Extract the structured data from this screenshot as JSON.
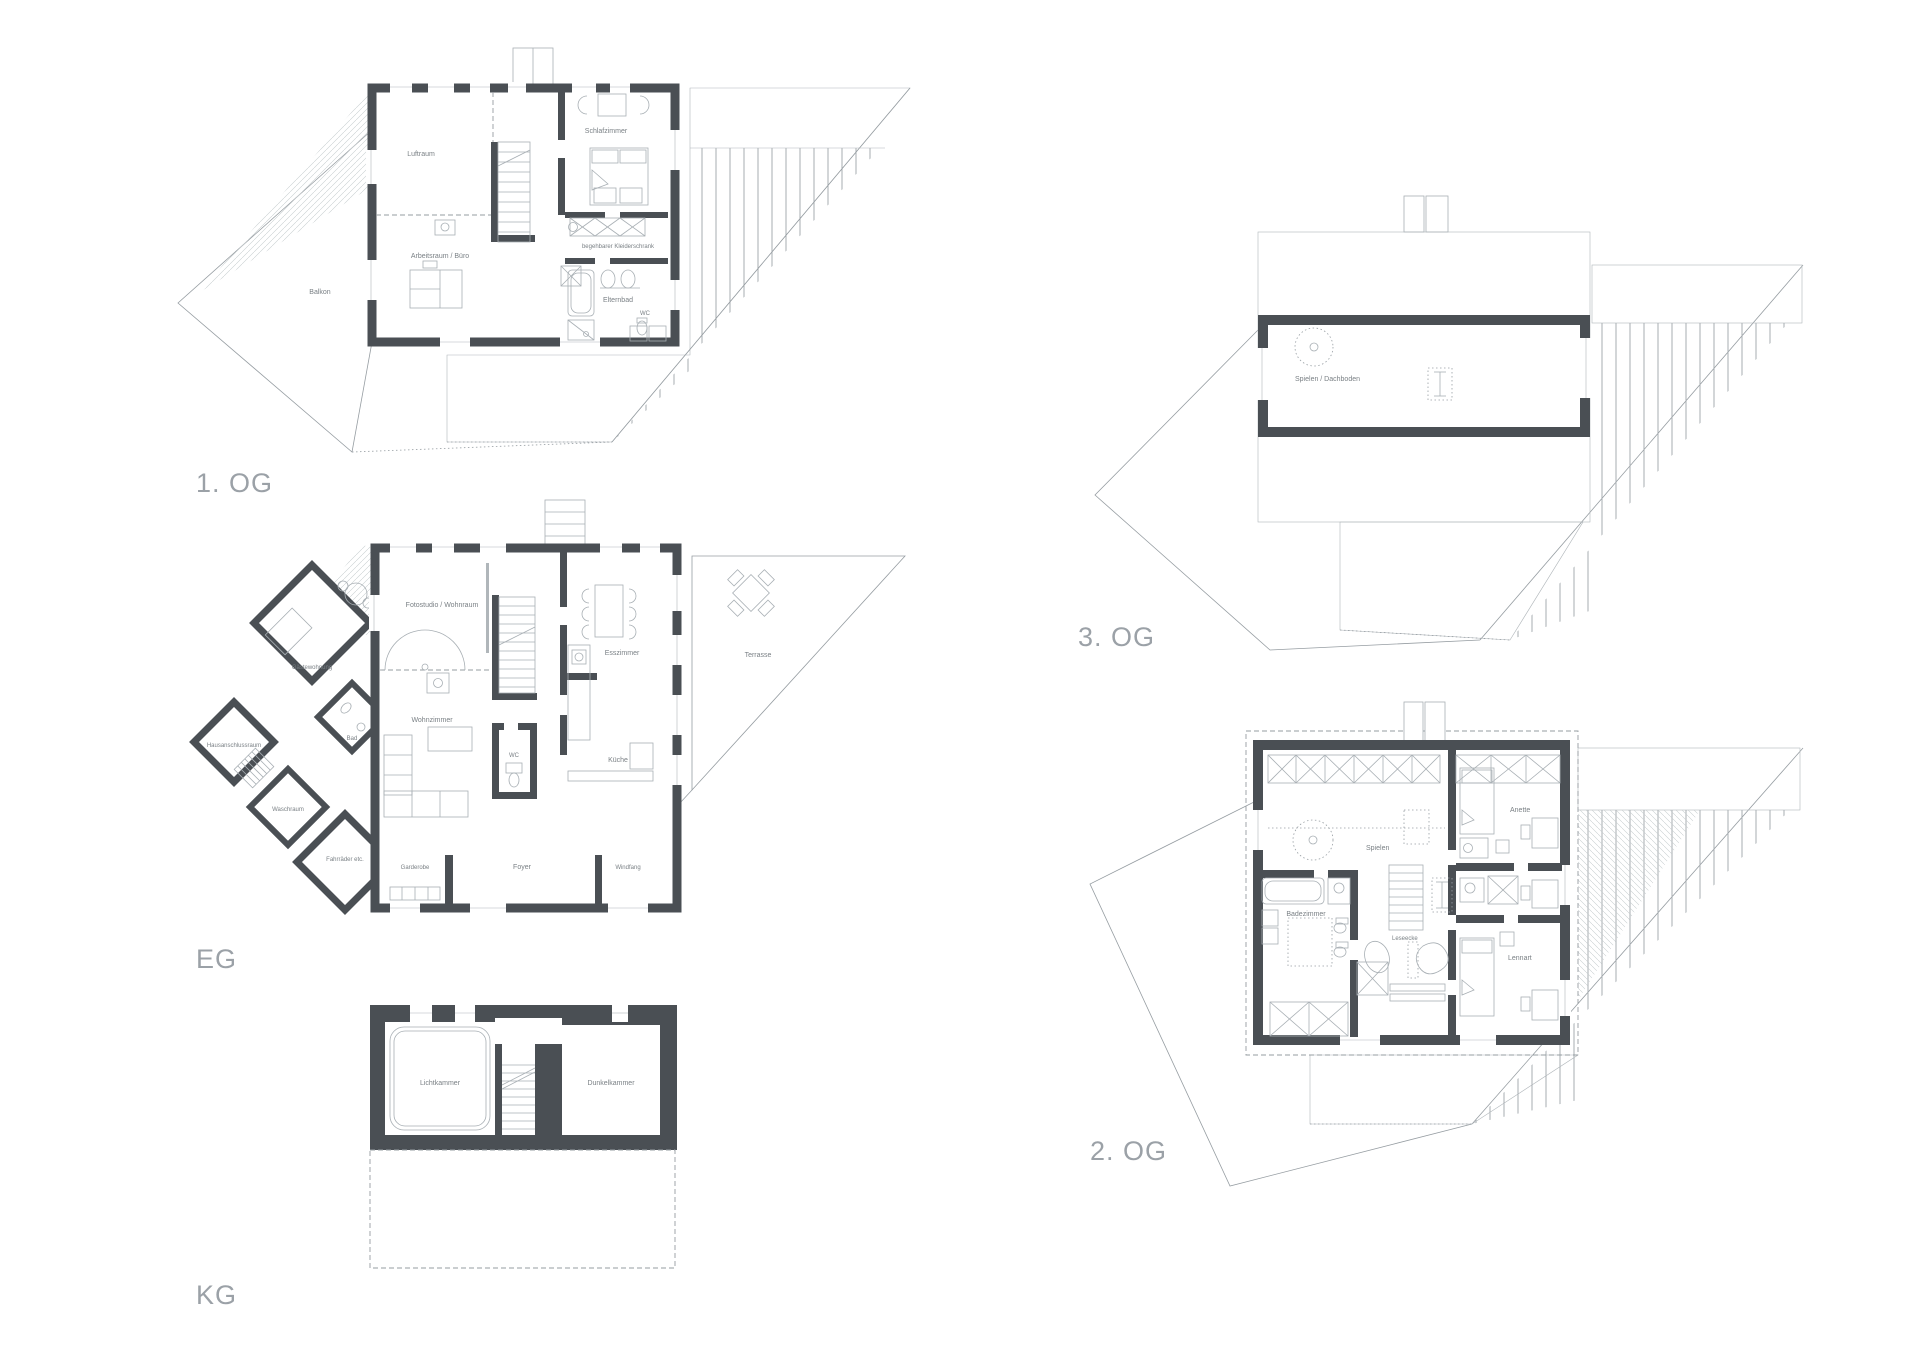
{
  "page": {
    "background": "#ffffff"
  },
  "colors": {
    "wall": "#4a4f54",
    "thin_line": "#969da2",
    "hatch": "#c3c8cb",
    "label_text": "#7a8085",
    "floor_label": "#9ba1a7"
  },
  "floors": {
    "og1": {
      "label": "1. OG",
      "rooms": {
        "luftraum": "Luftraum",
        "schlafzimmer": "Schlafzimmer",
        "arbeitsraum": "Arbeitsraum / Büro",
        "kleiderschrank": "begehbarer Kleiderschrank",
        "elternbad": "Elternbad",
        "wc": "WC",
        "balkon": "Balkon"
      }
    },
    "eg": {
      "label": "EG",
      "rooms": {
        "fotostudio": "Fotostudio / Wohnraum",
        "wohnzimmer": "Wohnzimmer",
        "esszimmer": "Esszimmer",
        "kueche": "Küche",
        "terrasse": "Terrasse",
        "wc": "WC",
        "foyer": "Foyer",
        "windfang": "Windfang",
        "garderobe": "Garderobe",
        "gaestewohnung": "Gästewohnung",
        "bad": "Bad",
        "hausanschlussraum": "Hausanschlussraum",
        "waschraum": "Waschraum",
        "fahrraeder": "Fahrräder etc."
      }
    },
    "kg": {
      "label": "KG",
      "rooms": {
        "lichtkammer": "Lichtkammer",
        "dunkelkammer": "Dunkelkammer"
      }
    },
    "og3": {
      "label": "3. OG",
      "rooms": {
        "spielen_dachboden": "Spielen / Dachboden"
      }
    },
    "og2": {
      "label": "2. OG",
      "rooms": {
        "spielen": "Spielen",
        "anette": "Anette",
        "lennart": "Lennart",
        "badezimmer": "Badezimmer",
        "leseecke": "Leseecke"
      }
    }
  }
}
